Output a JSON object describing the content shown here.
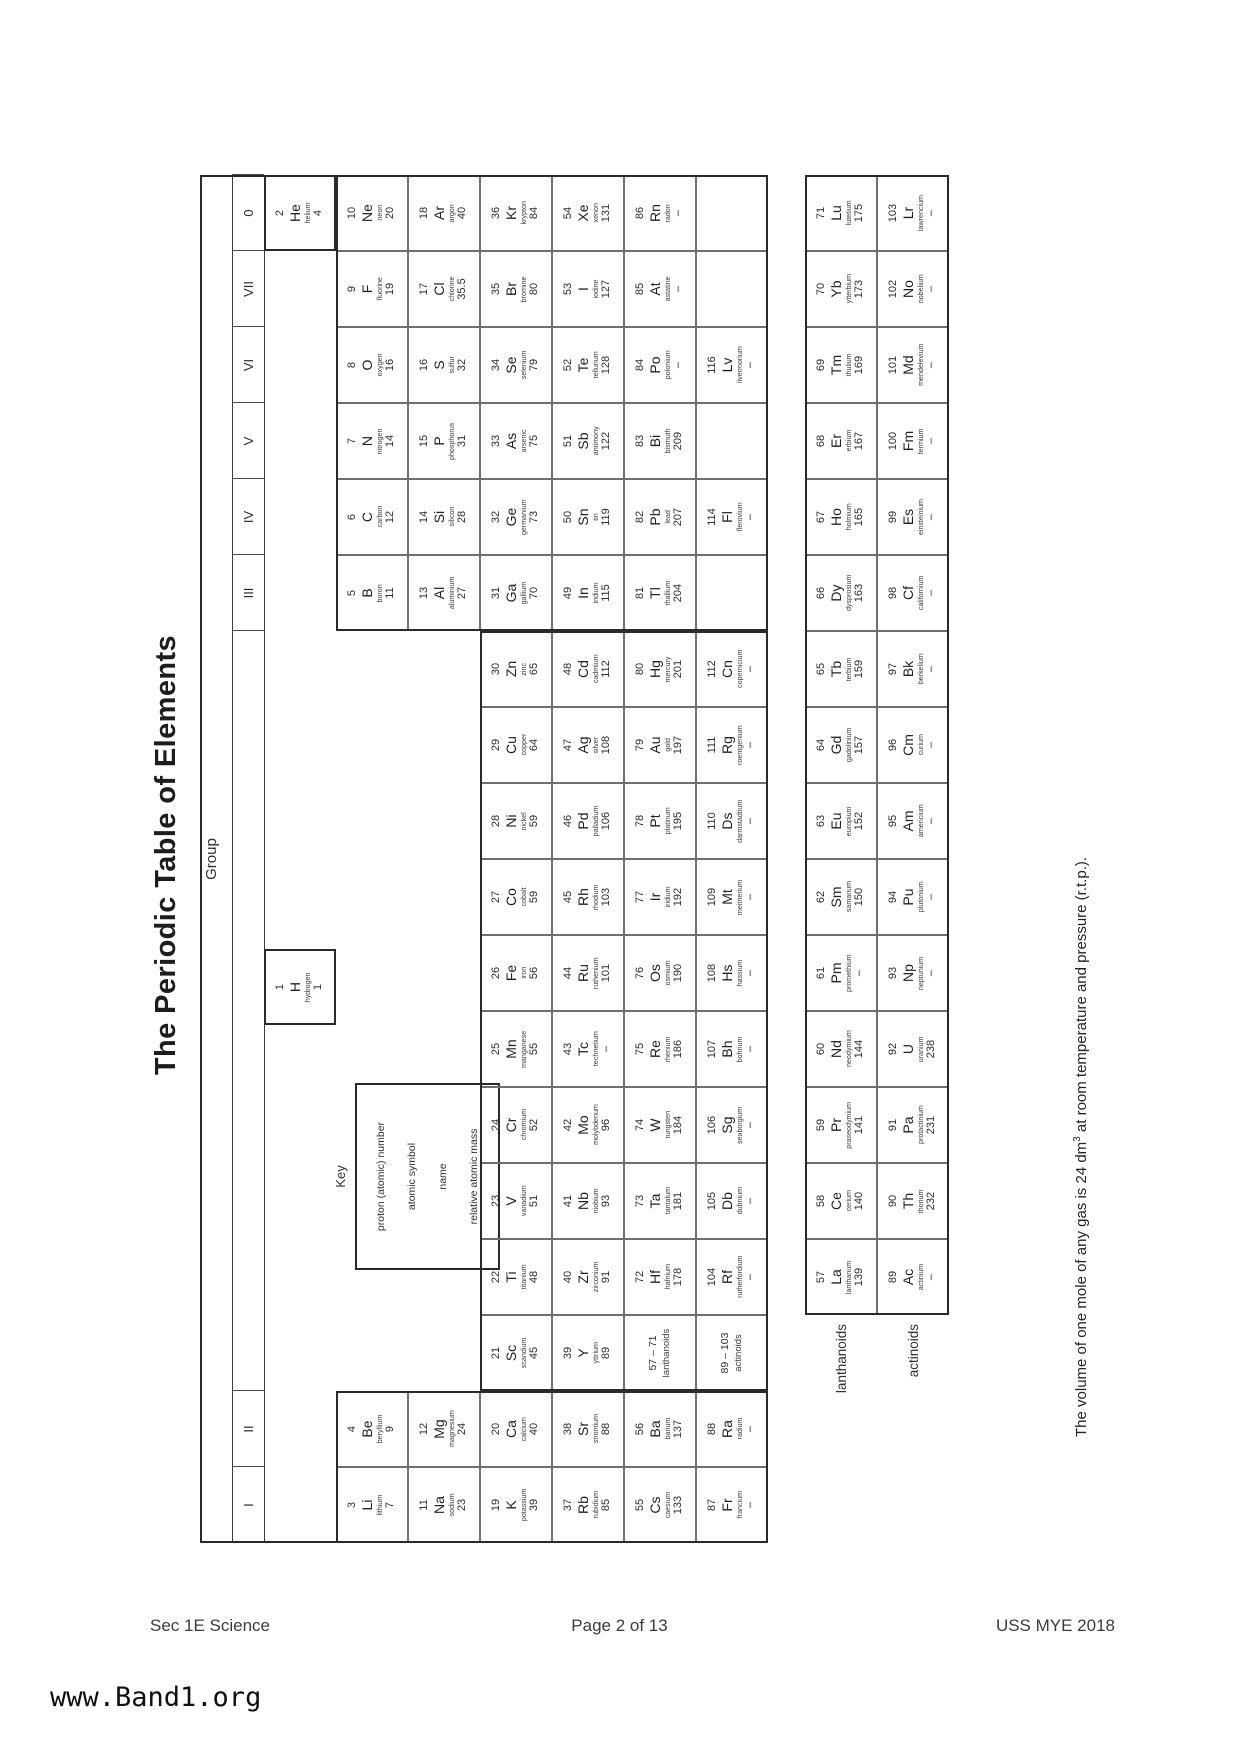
{
  "page": {
    "title": "The Periodic Table of Elements",
    "group_label": "Group",
    "group_numerals": [
      "I",
      "II",
      "III",
      "IV",
      "V",
      "VI",
      "VII",
      "0"
    ],
    "key": {
      "label": "Key",
      "lines": [
        "proton (atomic) number",
        "atomic symbol",
        "name",
        "relative atomic mass"
      ]
    },
    "placeholders": [
      {
        "range": "57 – 71",
        "label": "lanthanoids"
      },
      {
        "range": "89 – 103",
        "label": "actinoids"
      }
    ],
    "fblock_labels": [
      "lanthanoids",
      "actinoids"
    ],
    "note": {
      "before": "The volume of one mole of any gas is 24 dm",
      "sup": "3",
      "after": " at room temperature and pressure (r.t.p.)."
    },
    "footer": {
      "left": "Sec 1E Science",
      "center": "Page 2 of 13",
      "right": "USS MYE 2018"
    },
    "watermark": "www.Band1.org"
  },
  "elements": [
    {
      "n": 1,
      "s": "H",
      "nm": "hydrogen",
      "m": "1",
      "g": null,
      "p": 1
    },
    {
      "n": 2,
      "s": "He",
      "nm": "helium",
      "m": "4",
      "g": 18,
      "p": 1
    },
    {
      "n": 3,
      "s": "Li",
      "nm": "lithium",
      "m": "7",
      "g": 1,
      "p": 2
    },
    {
      "n": 4,
      "s": "Be",
      "nm": "beryllium",
      "m": "9",
      "g": 2,
      "p": 2
    },
    {
      "n": 5,
      "s": "B",
      "nm": "boron",
      "m": "11",
      "g": 13,
      "p": 2
    },
    {
      "n": 6,
      "s": "C",
      "nm": "carbon",
      "m": "12",
      "g": 14,
      "p": 2
    },
    {
      "n": 7,
      "s": "N",
      "nm": "nitrogen",
      "m": "14",
      "g": 15,
      "p": 2
    },
    {
      "n": 8,
      "s": "O",
      "nm": "oxygen",
      "m": "16",
      "g": 16,
      "p": 2
    },
    {
      "n": 9,
      "s": "F",
      "nm": "fluorine",
      "m": "19",
      "g": 17,
      "p": 2
    },
    {
      "n": 10,
      "s": "Ne",
      "nm": "neon",
      "m": "20",
      "g": 18,
      "p": 2
    },
    {
      "n": 11,
      "s": "Na",
      "nm": "sodium",
      "m": "23",
      "g": 1,
      "p": 3
    },
    {
      "n": 12,
      "s": "Mg",
      "nm": "magnesium",
      "m": "24",
      "g": 2,
      "p": 3
    },
    {
      "n": 13,
      "s": "Al",
      "nm": "aluminium",
      "m": "27",
      "g": 13,
      "p": 3
    },
    {
      "n": 14,
      "s": "Si",
      "nm": "silicon",
      "m": "28",
      "g": 14,
      "p": 3
    },
    {
      "n": 15,
      "s": "P",
      "nm": "phosphorus",
      "m": "31",
      "g": 15,
      "p": 3
    },
    {
      "n": 16,
      "s": "S",
      "nm": "sulfur",
      "m": "32",
      "g": 16,
      "p": 3
    },
    {
      "n": 17,
      "s": "Cl",
      "nm": "chlorine",
      "m": "35.5",
      "g": 17,
      "p": 3
    },
    {
      "n": 18,
      "s": "Ar",
      "nm": "argon",
      "m": "40",
      "g": 18,
      "p": 3
    },
    {
      "n": 19,
      "s": "K",
      "nm": "potassium",
      "m": "39",
      "g": 1,
      "p": 4
    },
    {
      "n": 20,
      "s": "Ca",
      "nm": "calcium",
      "m": "40",
      "g": 2,
      "p": 4
    },
    {
      "n": 21,
      "s": "Sc",
      "nm": "scandium",
      "m": "45",
      "g": 3,
      "p": 4
    },
    {
      "n": 22,
      "s": "Ti",
      "nm": "titanium",
      "m": "48",
      "g": 4,
      "p": 4
    },
    {
      "n": 23,
      "s": "V",
      "nm": "vanadium",
      "m": "51",
      "g": 5,
      "p": 4
    },
    {
      "n": 24,
      "s": "Cr",
      "nm": "chromium",
      "m": "52",
      "g": 6,
      "p": 4
    },
    {
      "n": 25,
      "s": "Mn",
      "nm": "manganese",
      "m": "55",
      "g": 7,
      "p": 4
    },
    {
      "n": 26,
      "s": "Fe",
      "nm": "iron",
      "m": "56",
      "g": 8,
      "p": 4
    },
    {
      "n": 27,
      "s": "Co",
      "nm": "cobalt",
      "m": "59",
      "g": 9,
      "p": 4
    },
    {
      "n": 28,
      "s": "Ni",
      "nm": "nickel",
      "m": "59",
      "g": 10,
      "p": 4
    },
    {
      "n": 29,
      "s": "Cu",
      "nm": "copper",
      "m": "64",
      "g": 11,
      "p": 4
    },
    {
      "n": 30,
      "s": "Zn",
      "nm": "zinc",
      "m": "65",
      "g": 12,
      "p": 4
    },
    {
      "n": 31,
      "s": "Ga",
      "nm": "gallium",
      "m": "70",
      "g": 13,
      "p": 4
    },
    {
      "n": 32,
      "s": "Ge",
      "nm": "germanium",
      "m": "73",
      "g": 14,
      "p": 4
    },
    {
      "n": 33,
      "s": "As",
      "nm": "arsenic",
      "m": "75",
      "g": 15,
      "p": 4
    },
    {
      "n": 34,
      "s": "Se",
      "nm": "selenium",
      "m": "79",
      "g": 16,
      "p": 4
    },
    {
      "n": 35,
      "s": "Br",
      "nm": "bromine",
      "m": "80",
      "g": 17,
      "p": 4
    },
    {
      "n": 36,
      "s": "Kr",
      "nm": "krypton",
      "m": "84",
      "g": 18,
      "p": 4
    },
    {
      "n": 37,
      "s": "Rb",
      "nm": "rubidium",
      "m": "85",
      "g": 1,
      "p": 5
    },
    {
      "n": 38,
      "s": "Sr",
      "nm": "strontium",
      "m": "88",
      "g": 2,
      "p": 5
    },
    {
      "n": 39,
      "s": "Y",
      "nm": "yttrium",
      "m": "89",
      "g": 3,
      "p": 5
    },
    {
      "n": 40,
      "s": "Zr",
      "nm": "zirconium",
      "m": "91",
      "g": 4,
      "p": 5
    },
    {
      "n": 41,
      "s": "Nb",
      "nm": "niobium",
      "m": "93",
      "g": 5,
      "p": 5
    },
    {
      "n": 42,
      "s": "Mo",
      "nm": "molybdenum",
      "m": "96",
      "g": 6,
      "p": 5
    },
    {
      "n": 43,
      "s": "Tc",
      "nm": "technetium",
      "m": "–",
      "g": 7,
      "p": 5
    },
    {
      "n": 44,
      "s": "Ru",
      "nm": "ruthenium",
      "m": "101",
      "g": 8,
      "p": 5
    },
    {
      "n": 45,
      "s": "Rh",
      "nm": "rhodium",
      "m": "103",
      "g": 9,
      "p": 5
    },
    {
      "n": 46,
      "s": "Pd",
      "nm": "palladium",
      "m": "106",
      "g": 10,
      "p": 5
    },
    {
      "n": 47,
      "s": "Ag",
      "nm": "silver",
      "m": "108",
      "g": 11,
      "p": 5
    },
    {
      "n": 48,
      "s": "Cd",
      "nm": "cadmium",
      "m": "112",
      "g": 12,
      "p": 5
    },
    {
      "n": 49,
      "s": "In",
      "nm": "indium",
      "m": "115",
      "g": 13,
      "p": 5
    },
    {
      "n": 50,
      "s": "Sn",
      "nm": "tin",
      "m": "119",
      "g": 14,
      "p": 5
    },
    {
      "n": 51,
      "s": "Sb",
      "nm": "antimony",
      "m": "122",
      "g": 15,
      "p": 5
    },
    {
      "n": 52,
      "s": "Te",
      "nm": "tellurium",
      "m": "128",
      "g": 16,
      "p": 5
    },
    {
      "n": 53,
      "s": "I",
      "nm": "iodine",
      "m": "127",
      "g": 17,
      "p": 5
    },
    {
      "n": 54,
      "s": "Xe",
      "nm": "xenon",
      "m": "131",
      "g": 18,
      "p": 5
    },
    {
      "n": 55,
      "s": "Cs",
      "nm": "caesium",
      "m": "133",
      "g": 1,
      "p": 6
    },
    {
      "n": 56,
      "s": "Ba",
      "nm": "barium",
      "m": "137",
      "g": 2,
      "p": 6
    },
    {
      "n": 72,
      "s": "Hf",
      "nm": "hafnium",
      "m": "178",
      "g": 4,
      "p": 6
    },
    {
      "n": 73,
      "s": "Ta",
      "nm": "tantalum",
      "m": "181",
      "g": 5,
      "p": 6
    },
    {
      "n": 74,
      "s": "W",
      "nm": "tungsten",
      "m": "184",
      "g": 6,
      "p": 6
    },
    {
      "n": 75,
      "s": "Re",
      "nm": "rhenium",
      "m": "186",
      "g": 7,
      "p": 6
    },
    {
      "n": 76,
      "s": "Os",
      "nm": "osmium",
      "m": "190",
      "g": 8,
      "p": 6
    },
    {
      "n": 77,
      "s": "Ir",
      "nm": "iridium",
      "m": "192",
      "g": 9,
      "p": 6
    },
    {
      "n": 78,
      "s": "Pt",
      "nm": "platinum",
      "m": "195",
      "g": 10,
      "p": 6
    },
    {
      "n": 79,
      "s": "Au",
      "nm": "gold",
      "m": "197",
      "g": 11,
      "p": 6
    },
    {
      "n": 80,
      "s": "Hg",
      "nm": "mercury",
      "m": "201",
      "g": 12,
      "p": 6
    },
    {
      "n": 81,
      "s": "Tl",
      "nm": "thallium",
      "m": "204",
      "g": 13,
      "p": 6
    },
    {
      "n": 82,
      "s": "Pb",
      "nm": "lead",
      "m": "207",
      "g": 14,
      "p": 6
    },
    {
      "n": 83,
      "s": "Bi",
      "nm": "bismuth",
      "m": "209",
      "g": 15,
      "p": 6
    },
    {
      "n": 84,
      "s": "Po",
      "nm": "polonium",
      "m": "–",
      "g": 16,
      "p": 6
    },
    {
      "n": 85,
      "s": "At",
      "nm": "astatine",
      "m": "–",
      "g": 17,
      "p": 6
    },
    {
      "n": 86,
      "s": "Rn",
      "nm": "radon",
      "m": "–",
      "g": 18,
      "p": 6
    },
    {
      "n": 87,
      "s": "Fr",
      "nm": "francium",
      "m": "–",
      "g": 1,
      "p": 7
    },
    {
      "n": 88,
      "s": "Ra",
      "nm": "radium",
      "m": "–",
      "g": 2,
      "p": 7
    },
    {
      "n": 104,
      "s": "Rf",
      "nm": "rutherfordium",
      "m": "–",
      "g": 4,
      "p": 7
    },
    {
      "n": 105,
      "s": "Db",
      "nm": "dubnium",
      "m": "–",
      "g": 5,
      "p": 7
    },
    {
      "n": 106,
      "s": "Sg",
      "nm": "seaborgium",
      "m": "–",
      "g": 6,
      "p": 7
    },
    {
      "n": 107,
      "s": "Bh",
      "nm": "bohrium",
      "m": "–",
      "g": 7,
      "p": 7
    },
    {
      "n": 108,
      "s": "Hs",
      "nm": "hassium",
      "m": "–",
      "g": 8,
      "p": 7
    },
    {
      "n": 109,
      "s": "Mt",
      "nm": "meitnerium",
      "m": "–",
      "g": 9,
      "p": 7
    },
    {
      "n": 110,
      "s": "Ds",
      "nm": "darmstadtium",
      "m": "–",
      "g": 10,
      "p": 7
    },
    {
      "n": 111,
      "s": "Rg",
      "nm": "roentgenium",
      "m": "–",
      "g": 11,
      "p": 7
    },
    {
      "n": 112,
      "s": "Cn",
      "nm": "copernicium",
      "m": "–",
      "g": 12,
      "p": 7
    },
    {
      "n": 114,
      "s": "Fl",
      "nm": "flerovium",
      "m": "–",
      "g": 14,
      "p": 7
    },
    {
      "n": 116,
      "s": "Lv",
      "nm": "livermorium",
      "m": "–",
      "g": 16,
      "p": 7
    }
  ],
  "lanthanoids": [
    {
      "n": 57,
      "s": "La",
      "nm": "lanthanum",
      "m": "139"
    },
    {
      "n": 58,
      "s": "Ce",
      "nm": "cerium",
      "m": "140"
    },
    {
      "n": 59,
      "s": "Pr",
      "nm": "praseodymium",
      "m": "141"
    },
    {
      "n": 60,
      "s": "Nd",
      "nm": "neodymium",
      "m": "144"
    },
    {
      "n": 61,
      "s": "Pm",
      "nm": "promethium",
      "m": "–"
    },
    {
      "n": 62,
      "s": "Sm",
      "nm": "samarium",
      "m": "150"
    },
    {
      "n": 63,
      "s": "Eu",
      "nm": "europium",
      "m": "152"
    },
    {
      "n": 64,
      "s": "Gd",
      "nm": "gadolinium",
      "m": "157"
    },
    {
      "n": 65,
      "s": "Tb",
      "nm": "terbium",
      "m": "159"
    },
    {
      "n": 66,
      "s": "Dy",
      "nm": "dysprosium",
      "m": "163"
    },
    {
      "n": 67,
      "s": "Ho",
      "nm": "holmium",
      "m": "165"
    },
    {
      "n": 68,
      "s": "Er",
      "nm": "erbium",
      "m": "167"
    },
    {
      "n": 69,
      "s": "Tm",
      "nm": "thulium",
      "m": "169"
    },
    {
      "n": 70,
      "s": "Yb",
      "nm": "ytterbium",
      "m": "173"
    },
    {
      "n": 71,
      "s": "Lu",
      "nm": "lutetium",
      "m": "175"
    }
  ],
  "actinoids": [
    {
      "n": 89,
      "s": "Ac",
      "nm": "actinium",
      "m": "–"
    },
    {
      "n": 90,
      "s": "Th",
      "nm": "thorium",
      "m": "232"
    },
    {
      "n": 91,
      "s": "Pa",
      "nm": "protactinium",
      "m": "231"
    },
    {
      "n": 92,
      "s": "U",
      "nm": "uranium",
      "m": "238"
    },
    {
      "n": 93,
      "s": "Np",
      "nm": "neptunium",
      "m": "–"
    },
    {
      "n": 94,
      "s": "Pu",
      "nm": "plutonium",
      "m": "–"
    },
    {
      "n": 95,
      "s": "Am",
      "nm": "americium",
      "m": "–"
    },
    {
      "n": 96,
      "s": "Cm",
      "nm": "curium",
      "m": "–"
    },
    {
      "n": 97,
      "s": "Bk",
      "nm": "berkelium",
      "m": "–"
    },
    {
      "n": 98,
      "s": "Cf",
      "nm": "californium",
      "m": "–"
    },
    {
      "n": 99,
      "s": "Es",
      "nm": "einsteinium",
      "m": "–"
    },
    {
      "n": 100,
      "s": "Fm",
      "nm": "fermium",
      "m": "–"
    },
    {
      "n": 101,
      "s": "Md",
      "nm": "mendelevium",
      "m": "–"
    },
    {
      "n": 102,
      "s": "No",
      "nm": "nobelium",
      "m": "–"
    },
    {
      "n": 103,
      "s": "Lr",
      "nm": "lawrencium",
      "m": "–"
    }
  ],
  "empty_cells": [
    {
      "g": 13,
      "p": 7
    },
    {
      "g": 15,
      "p": 7
    },
    {
      "g": 17,
      "p": 7
    },
    {
      "g": 18,
      "p": 7
    }
  ]
}
